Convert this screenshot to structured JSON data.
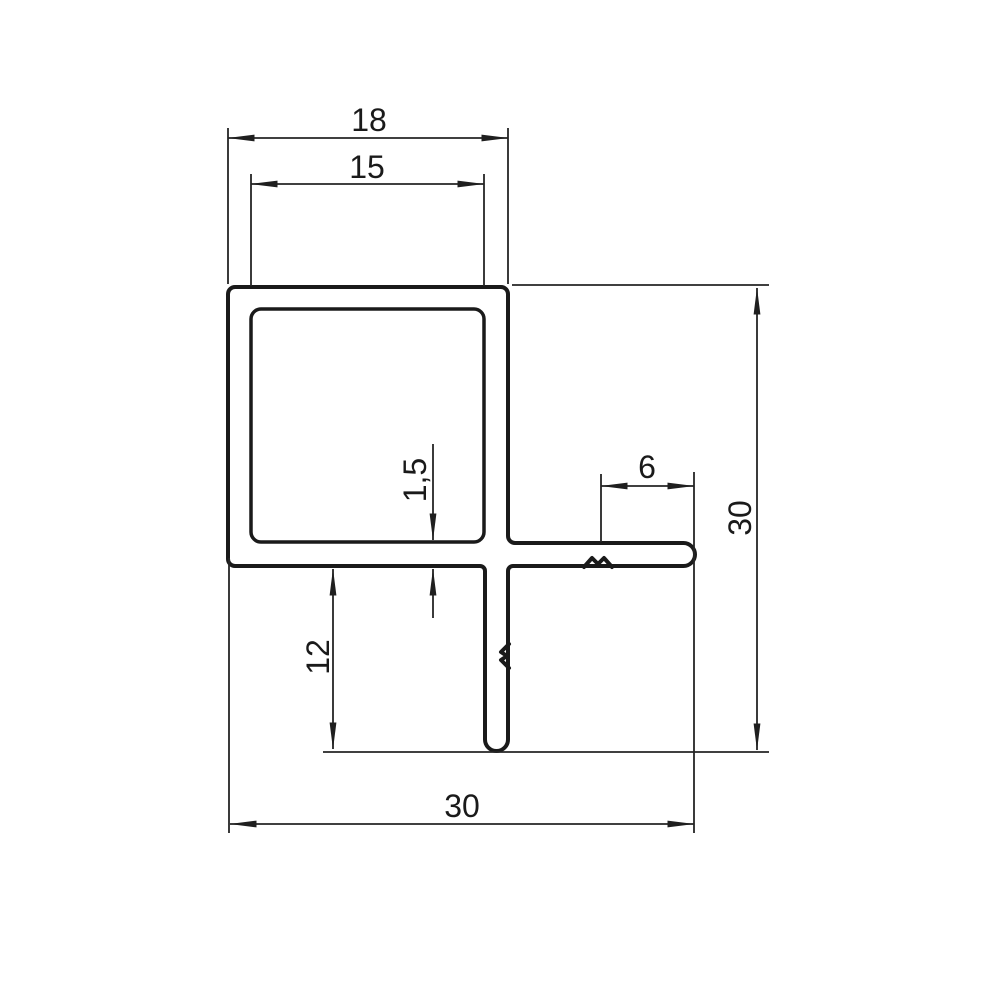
{
  "drawing": {
    "labels": {
      "outer_width": "18",
      "inner_width": "15",
      "wall_thickness": "1,5",
      "flange_tail": "6",
      "leg_length": "12",
      "overall_width": "30",
      "overall_height": "30"
    },
    "colors": {
      "line": "#1a1a1a",
      "dimension": "#252525",
      "background": "#ffffff"
    }
  }
}
